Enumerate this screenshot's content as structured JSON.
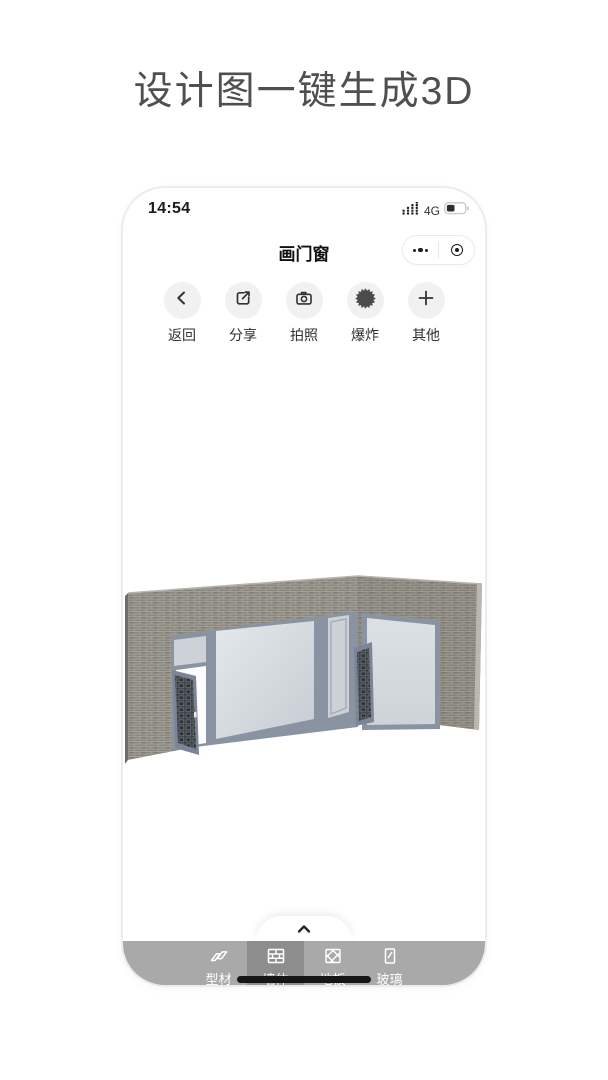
{
  "hero": {
    "title": "设计图一键生成3D"
  },
  "status_bar": {
    "time": "14:54",
    "network": "4G",
    "signal_icon": "signal-dots",
    "battery_icon": "battery-partial"
  },
  "nav": {
    "title": "画门窗",
    "capsule": {
      "more_icon": "ellipsis-more",
      "home_icon": "target-circle"
    }
  },
  "toolbar": [
    {
      "label": "返回",
      "icon": "back-chevron-icon"
    },
    {
      "label": "分享",
      "icon": "share-box-arrow-icon"
    },
    {
      "label": "拍照",
      "icon": "camera-icon"
    },
    {
      "label": "爆炸",
      "icon": "explode-starburst-icon"
    },
    {
      "label": "其他",
      "icon": "plus-icon"
    }
  ],
  "canvas": {
    "model": "L-shaped brick corner wall with aluminum-framed windows, open carved-grille door and open grille casement",
    "colors": {
      "brick": "#89867d",
      "mortar": "#b2afa8",
      "frame": "#8a93a2",
      "glass": "#d6dbdf",
      "grille": "#3b3f45"
    }
  },
  "sheet": {
    "handle_icon": "chevron-up-icon"
  },
  "tab_bar": {
    "items": [
      {
        "label": "型材",
        "icon": "profile-extrusion-icon",
        "selected": false
      },
      {
        "label": "墙体",
        "icon": "brick-wall-icon",
        "selected": true
      },
      {
        "label": "地板",
        "icon": "floor-hatch-icon",
        "selected": false
      },
      {
        "label": "玻璃",
        "icon": "glass-pane-icon",
        "selected": false
      }
    ],
    "colors": {
      "bar": "#a9a9a9",
      "selected": "#8d8d8d"
    }
  }
}
